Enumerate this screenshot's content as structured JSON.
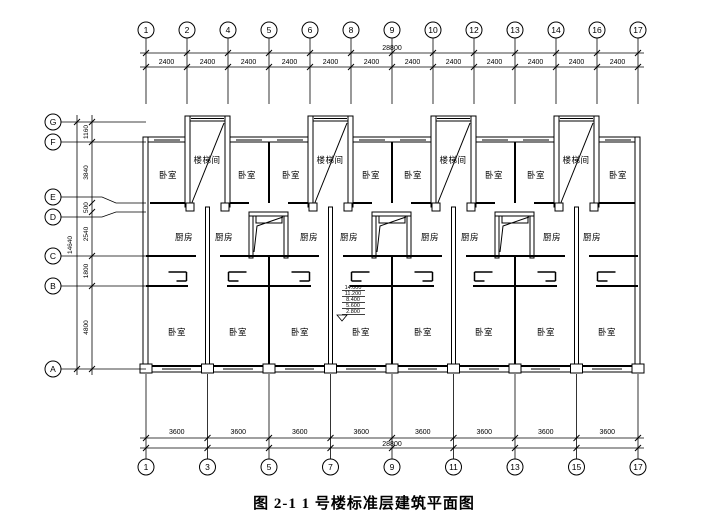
{
  "figure": {
    "caption": "图 2-1 1 号楼标准层建筑平面图"
  },
  "top_axis": {
    "bubbles": [
      "1",
      "2",
      "4",
      "5",
      "6",
      "8",
      "9",
      "10",
      "12",
      "13",
      "14",
      "16",
      "17"
    ],
    "total": "28800",
    "segments": [
      "2400",
      "2400",
      "2400",
      "2400",
      "2400",
      "2400",
      "2400",
      "2400",
      "2400",
      "2400",
      "2400",
      "2400"
    ]
  },
  "bottom_axis": {
    "bubbles": [
      "1",
      "3",
      "5",
      "7",
      "9",
      "11",
      "13",
      "15",
      "17"
    ],
    "total": "28800",
    "segments": [
      "3600",
      "3600",
      "3600",
      "3600",
      "3600",
      "3600",
      "3600",
      "3600"
    ]
  },
  "left_axis": {
    "bubbles": [
      "G",
      "F",
      "E",
      "D",
      "C",
      "B",
      "A"
    ],
    "total": "14640",
    "segments": [
      "1160",
      "3840",
      "500",
      "2540",
      "1800",
      "4800"
    ]
  },
  "rooms": {
    "top_row": [
      {
        "label": "卧室",
        "x": 168,
        "y": 178
      },
      {
        "label": "楼梯间",
        "x": 207,
        "y": 163
      },
      {
        "label": "卧室",
        "x": 247,
        "y": 178
      },
      {
        "label": "卧室",
        "x": 291,
        "y": 178
      },
      {
        "label": "楼梯间",
        "x": 330,
        "y": 163
      },
      {
        "label": "卧室",
        "x": 371,
        "y": 178
      },
      {
        "label": "卧室",
        "x": 413,
        "y": 178
      },
      {
        "label": "楼梯间",
        "x": 453,
        "y": 163
      },
      {
        "label": "卧室",
        "x": 494,
        "y": 178
      },
      {
        "label": "卧室",
        "x": 536,
        "y": 178
      },
      {
        "label": "楼梯间",
        "x": 576,
        "y": 163
      },
      {
        "label": "卧室",
        "x": 618,
        "y": 178
      }
    ],
    "kitchen_row": [
      {
        "label": "厨房",
        "x": 184,
        "y": 240
      },
      {
        "label": "厨房",
        "x": 224,
        "y": 240
      },
      {
        "label": "厨房",
        "x": 309,
        "y": 240
      },
      {
        "label": "厨房",
        "x": 349,
        "y": 240
      },
      {
        "label": "厨房",
        "x": 430,
        "y": 240
      },
      {
        "label": "厨房",
        "x": 470,
        "y": 240
      },
      {
        "label": "厨房",
        "x": 552,
        "y": 240
      },
      {
        "label": "厨房",
        "x": 592,
        "y": 240
      }
    ],
    "bottom_row": [
      {
        "label": "卧室",
        "x": 177,
        "y": 335
      },
      {
        "label": "卧室",
        "x": 238,
        "y": 335
      },
      {
        "label": "卧室",
        "x": 300,
        "y": 335
      },
      {
        "label": "卧室",
        "x": 361,
        "y": 335
      },
      {
        "label": "卧室",
        "x": 423,
        "y": 335
      },
      {
        "label": "卧室",
        "x": 484,
        "y": 335
      },
      {
        "label": "卧室",
        "x": 546,
        "y": 335
      },
      {
        "label": "卧室",
        "x": 607,
        "y": 335
      }
    ]
  },
  "elevation_marks": {
    "values": [
      "14.000",
      "11.200",
      "8.400",
      "5.600",
      "2.800"
    ]
  }
}
